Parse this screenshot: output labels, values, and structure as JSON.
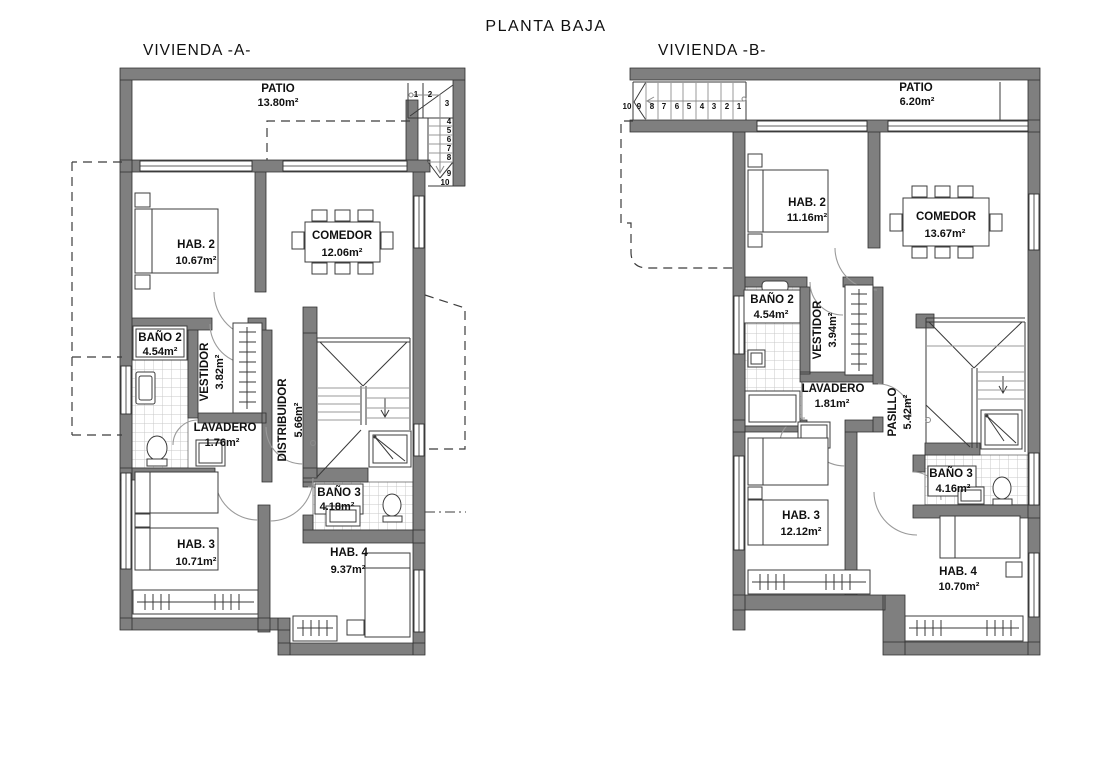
{
  "title": "PLANTA BAJA",
  "viviendaA": {
    "label": "VIVIENDA -A-",
    "patio": {
      "name": "PATIO",
      "area": "13.80m²"
    },
    "hab2": {
      "name": "HAB. 2",
      "area": "10.67m²"
    },
    "comedor": {
      "name": "COMEDOR",
      "area": "12.06m²"
    },
    "bano2": {
      "name": "BAÑO 2",
      "area": "4.54m²"
    },
    "vestidor": {
      "name": "VESTIDOR",
      "area": "3.82m²"
    },
    "lavadero": {
      "name": "LAVADERO",
      "area": "1.76m²"
    },
    "distribuidor": {
      "name": "DISTRIBUIDOR",
      "area": "5.66m²"
    },
    "bano3": {
      "name": "BAÑO 3",
      "area": "4.18m²"
    },
    "hab3": {
      "name": "HAB. 3",
      "area": "10.71m²"
    },
    "hab4": {
      "name": "HAB. 4",
      "area": "9.37m²"
    },
    "stair_numbers": [
      "1",
      "2",
      "3",
      "4",
      "5",
      "6",
      "7",
      "8",
      "9",
      "10"
    ]
  },
  "viviendaB": {
    "label": "VIVIENDA -B-",
    "patio": {
      "name": "PATIO",
      "area": "6.20m²"
    },
    "hab2": {
      "name": "HAB. 2",
      "area": "11.16m²"
    },
    "comedor": {
      "name": "COMEDOR",
      "area": "13.67m²"
    },
    "bano2": {
      "name": "BAÑO 2",
      "area": "4.54m²"
    },
    "vestidor": {
      "name": "VESTIDOR",
      "area": "3.94m²"
    },
    "lavadero": {
      "name": "LAVADERO",
      "area": "1.81m²"
    },
    "pasillo": {
      "name": "PASILLO",
      "area": "5.42m²"
    },
    "bano3": {
      "name": "BAÑO 3",
      "area": "4.16m²"
    },
    "hab3": {
      "name": "HAB. 3",
      "area": "12.12m²"
    },
    "hab4": {
      "name": "HAB. 4",
      "area": "10.70m²"
    },
    "stair_numbers": [
      "10",
      "9",
      "8",
      "7",
      "6",
      "5",
      "4",
      "3",
      "2",
      "1"
    ]
  }
}
